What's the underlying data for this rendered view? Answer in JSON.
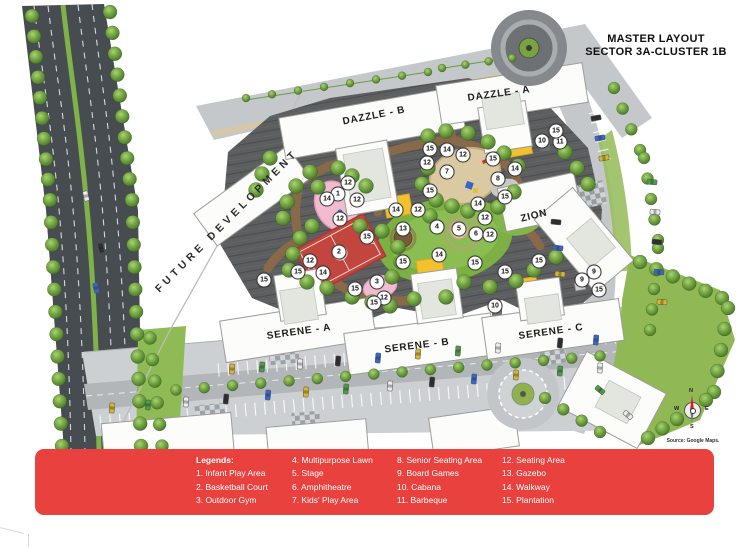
{
  "header": {
    "line1": "MASTER LAYOUT",
    "line2": "SECTOR 3A-CLUSTER 1B"
  },
  "map": {
    "future_label": "FUTURE DEVELOPMENT",
    "buildings": [
      {
        "name": "DAZZLE - B",
        "x": 374,
        "y": 116,
        "rot": -11
      },
      {
        "name": "DAZZLE - A",
        "x": 499,
        "y": 94,
        "rot": -8
      },
      {
        "name": "ZION",
        "x": 534,
        "y": 216,
        "rot": -14
      },
      {
        "name": "SERENE - A",
        "x": 299,
        "y": 332,
        "rot": -8
      },
      {
        "name": "SERENE - B",
        "x": 417,
        "y": 346,
        "rot": -7
      },
      {
        "name": "SERENE - C",
        "x": 551,
        "y": 332,
        "rot": -8
      }
    ],
    "markers": [
      {
        "n": 1,
        "x": 338,
        "y": 194
      },
      {
        "n": 2,
        "x": 339,
        "y": 252
      },
      {
        "n": 3,
        "x": 377,
        "y": 282
      },
      {
        "n": 4,
        "x": 437,
        "y": 227
      },
      {
        "n": 5,
        "x": 459,
        "y": 229
      },
      {
        "n": 6,
        "x": 476,
        "y": 234
      },
      {
        "n": 7,
        "x": 447,
        "y": 172
      },
      {
        "n": 8,
        "x": 498,
        "y": 179
      },
      {
        "n": 9,
        "x": 582,
        "y": 280
      },
      {
        "n": 9,
        "x": 594,
        "y": 272
      },
      {
        "n": 10,
        "x": 542,
        "y": 141
      },
      {
        "n": 10,
        "x": 495,
        "y": 306
      },
      {
        "n": 11,
        "x": 560,
        "y": 142
      },
      {
        "n": 12,
        "x": 427,
        "y": 163
      },
      {
        "n": 12,
        "x": 463,
        "y": 155
      },
      {
        "n": 12,
        "x": 348,
        "y": 183
      },
      {
        "n": 12,
        "x": 357,
        "y": 200
      },
      {
        "n": 12,
        "x": 340,
        "y": 219
      },
      {
        "n": 12,
        "x": 418,
        "y": 210
      },
      {
        "n": 12,
        "x": 485,
        "y": 218
      },
      {
        "n": 12,
        "x": 490,
        "y": 235
      },
      {
        "n": 12,
        "x": 310,
        "y": 261
      },
      {
        "n": 12,
        "x": 384,
        "y": 298
      },
      {
        "n": 13,
        "x": 403,
        "y": 229
      },
      {
        "n": 14,
        "x": 447,
        "y": 150
      },
      {
        "n": 14,
        "x": 515,
        "y": 169
      },
      {
        "n": 14,
        "x": 478,
        "y": 204
      },
      {
        "n": 14,
        "x": 327,
        "y": 199
      },
      {
        "n": 14,
        "x": 396,
        "y": 210
      },
      {
        "n": 14,
        "x": 323,
        "y": 273
      },
      {
        "n": 14,
        "x": 439,
        "y": 255
      },
      {
        "n": 15,
        "x": 556,
        "y": 131
      },
      {
        "n": 15,
        "x": 430,
        "y": 149
      },
      {
        "n": 15,
        "x": 493,
        "y": 159
      },
      {
        "n": 15,
        "x": 505,
        "y": 197
      },
      {
        "n": 15,
        "x": 430,
        "y": 191
      },
      {
        "n": 15,
        "x": 367,
        "y": 237
      },
      {
        "n": 15,
        "x": 298,
        "y": 272
      },
      {
        "n": 15,
        "x": 264,
        "y": 280
      },
      {
        "n": 15,
        "x": 403,
        "y": 262
      },
      {
        "n": 15,
        "x": 355,
        "y": 289
      },
      {
        "n": 15,
        "x": 374,
        "y": 303
      },
      {
        "n": 15,
        "x": 475,
        "y": 263
      },
      {
        "n": 15,
        "x": 505,
        "y": 272
      },
      {
        "n": 15,
        "x": 539,
        "y": 261
      },
      {
        "n": 15,
        "x": 599,
        "y": 290
      }
    ]
  },
  "compass": {
    "n": "N",
    "e": "E",
    "s": "S",
    "w": "W"
  },
  "source_note": "Source: Google Maps.",
  "legend": {
    "title": "Legends:",
    "columns": [
      [
        "1. Infant Play Area",
        "2. Basketball Court",
        "3. Outdoor Gym"
      ],
      [
        "4. Multipurpose Lawn",
        "5. Stage",
        "6. Amphitheatre",
        "7. Kids' Play Area"
      ],
      [
        "8. Senior Seating Area",
        "9. Board Games",
        "10. Cabana",
        "11. Barbeque"
      ],
      [
        "12. Seating Area",
        "13. Gazebo",
        "14. Walkway",
        "15. Plantation"
      ]
    ]
  },
  "colors": {
    "legend_bar": "#E8413E",
    "road_dark": "#474C51",
    "lawn": "#7CB042",
    "basketball_court": "#C2453E",
    "marker_bg": "#FFFFFF"
  }
}
